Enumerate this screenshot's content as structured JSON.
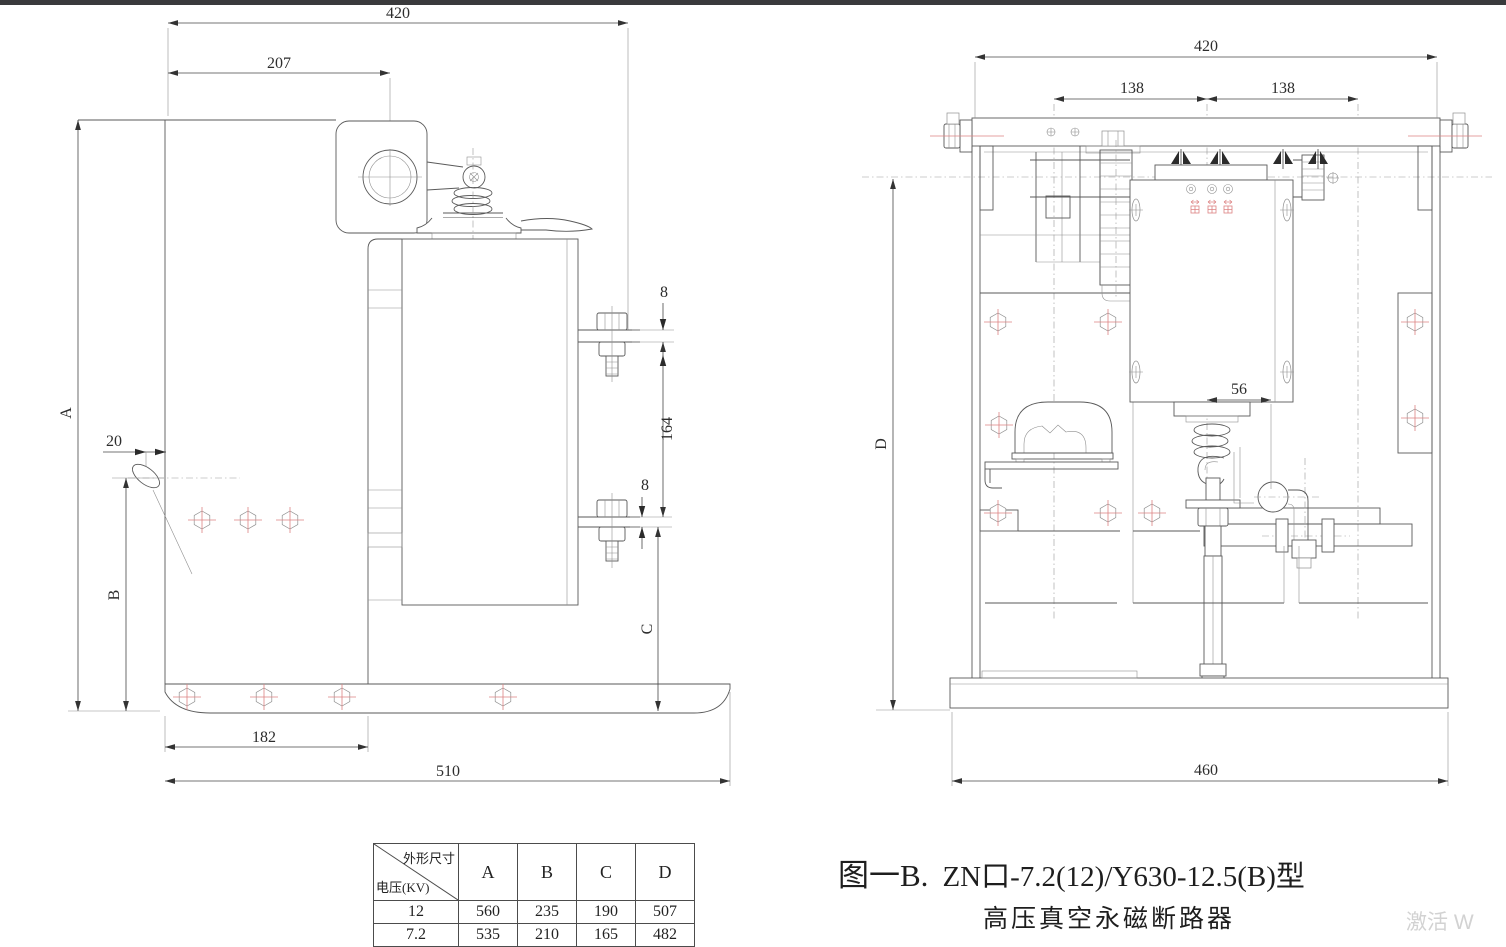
{
  "left_view": {
    "dims": {
      "overall_width": "420",
      "upper_width": "207",
      "pad_top": "8",
      "terminal_span": "164",
      "pad_bottom": "8",
      "handle_offset": "20",
      "height_a": "A",
      "height_b": "B",
      "height_c": "C",
      "hole_span": "182",
      "base_width": "510"
    }
  },
  "right_view": {
    "dims": {
      "overall_width": "420",
      "pitch_left": "138",
      "pitch_right": "138",
      "rod_offset": "56",
      "height_d": "D",
      "base_width": "460"
    }
  },
  "table": {
    "corner_top": "外形尺寸",
    "corner_bottom": "电压(KV)",
    "columns": [
      "A",
      "B",
      "C",
      "D"
    ],
    "rows": [
      {
        "voltage": "12",
        "values": [
          "560",
          "235",
          "190",
          "507"
        ]
      },
      {
        "voltage": "7.2",
        "values": [
          "535",
          "210",
          "165",
          "482"
        ]
      }
    ]
  },
  "caption": {
    "figure": "图一B.",
    "model": "ZN口-7.2(12)/Y630-12.5(B)型",
    "subtitle": "高压真空永磁断路器"
  },
  "watermark": "激活 W"
}
